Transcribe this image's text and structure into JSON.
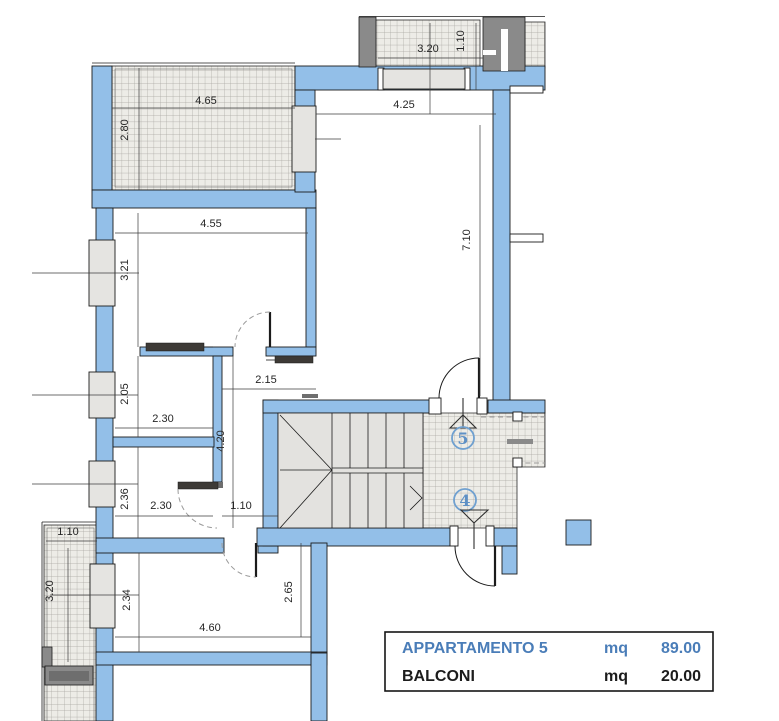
{
  "colors": {
    "wall_fill": "#93BFE8",
    "marker_blue": "#6FA0D0",
    "legend_accent": "#4A7DB8",
    "balcony_hatch_bg": "#EDECE7"
  },
  "dimensions": {
    "balcony_nw_width": "4.65",
    "balcony_nw_depth": "2.80",
    "balcony_n_width": "3.20",
    "balcony_n_depth": "1.10",
    "living_width": "4.25",
    "living_depth": "7.10",
    "bedroom_nw_width": "4.55",
    "bedroom_nw_depth": "3.21",
    "hall_entry_width": "2.15",
    "room_w_depth": "2.05",
    "room_w_width": "2.30",
    "corridor_length": "4.20",
    "room_sw_depth": "2.36",
    "room_sw_width": "2.30",
    "corridor_width": "1.10",
    "bedroom_s_depth_left": "2.34",
    "bedroom_s_depth_right": "2.65",
    "bedroom_s_width": "4.60",
    "balcony_w_width": "1.10",
    "balcony_w_depth": "3.20"
  },
  "stairwell": {
    "upper_floor_marker": "5",
    "lower_floor_marker": "4"
  },
  "legend": {
    "rows": [
      {
        "name": "APPARTAMENTO 5",
        "unit": "mq",
        "area": "89.00"
      },
      {
        "name": "BALCONI",
        "unit": "mq",
        "area": "20.00"
      }
    ]
  }
}
